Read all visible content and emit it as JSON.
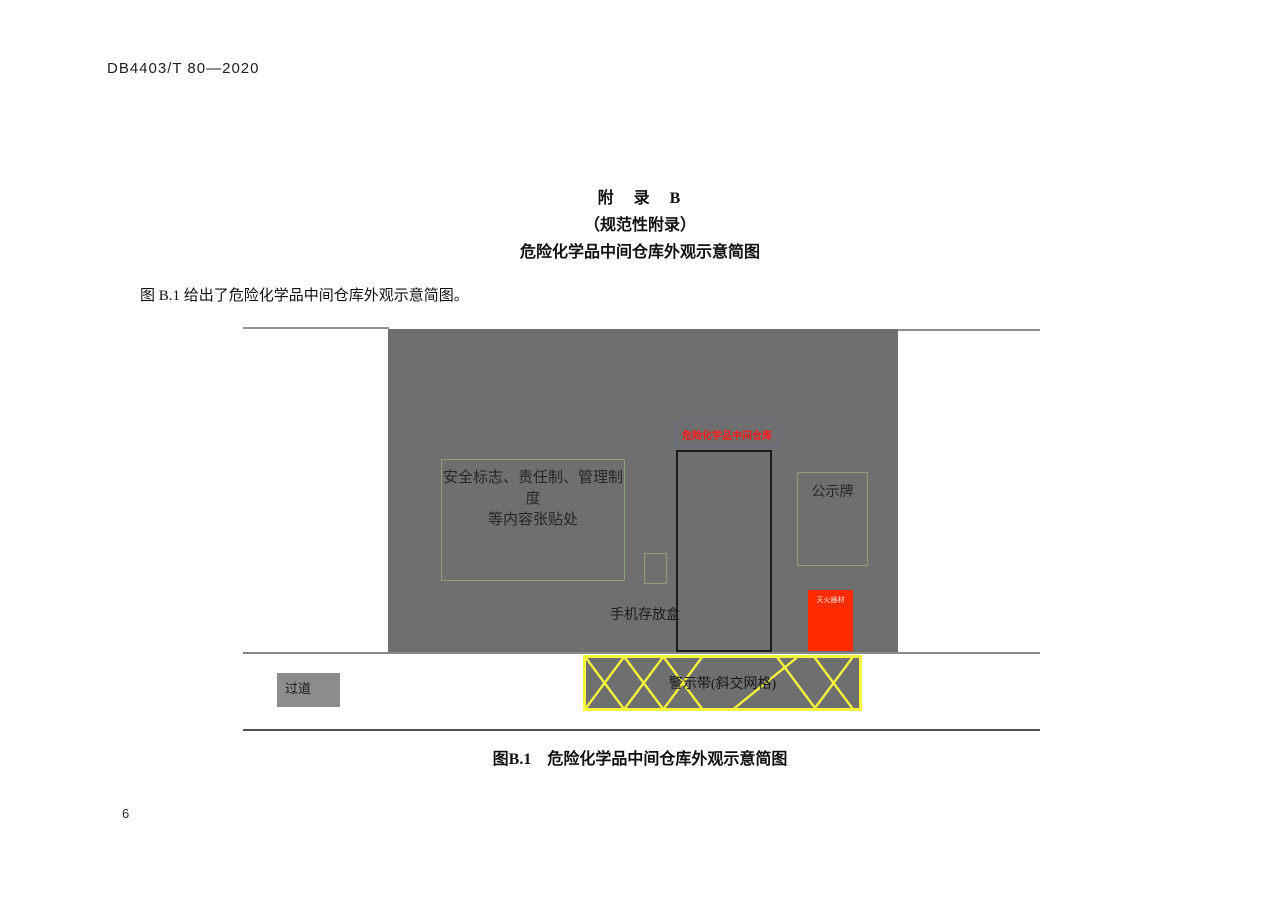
{
  "page": {
    "header": "DB4403/T 80—2020",
    "page_number": "6"
  },
  "appendix": {
    "heading_line1": "附　录　B",
    "heading_line2": "（规范性附录）",
    "heading_line3": "危险化学品中间仓库外观示意简图",
    "intro": "图 B.1 给出了危险化学品中间仓库外观示意简图。"
  },
  "figure": {
    "caption": "图B.1　危险化学品中间仓库外观示意简图",
    "labels": {
      "posting_area_line1": "安全标志、责任制、管理制度",
      "posting_area_line2": "等内容张贴处",
      "door_sign": "危险化学品中间仓库",
      "notice_board": "公示牌",
      "phone_box": "手机存放盒",
      "fire_equipment": "灭火器材",
      "warning_tape": "警示带(斜交网格)",
      "passage": "过道"
    },
    "colors": {
      "building_gray": "#6f6f6f",
      "passage_gray": "#8c8c8c",
      "tape_yellow": "#f5f53c",
      "alarm_red": "#ff2b00",
      "sign_text_red": "#ff1a1a",
      "outline_green": "#8ba374",
      "sign_border_blue": "#5f718a",
      "door_outline": "#1c1c1c"
    }
  }
}
